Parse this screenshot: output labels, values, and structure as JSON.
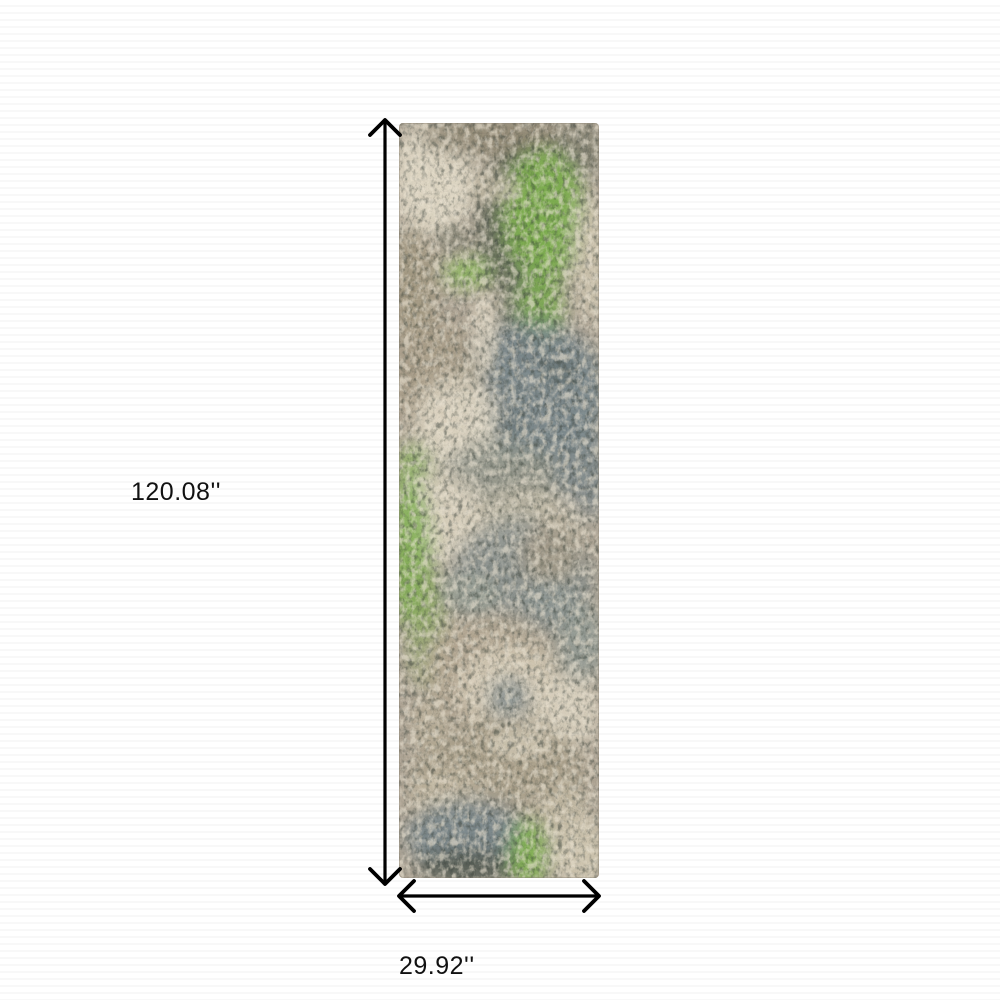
{
  "image": {
    "type": "product-dimension-diagram",
    "subject": "abstract runner rug with gray, beige, slate blue and green mottled pattern"
  },
  "dimensions": {
    "height_label": "120.08''",
    "width_label": "29.92''"
  },
  "palette": {
    "background": "#ffffff",
    "arrow": "#000000",
    "label_text": "#111111",
    "rug_base": "#ab9f8c",
    "rug_taupe": "#a89c86",
    "rug_cream": "#e5dcc8",
    "rug_slate": "#75848a",
    "rug_dark_gray": "#575e55",
    "rug_green": "#7cb14d"
  }
}
